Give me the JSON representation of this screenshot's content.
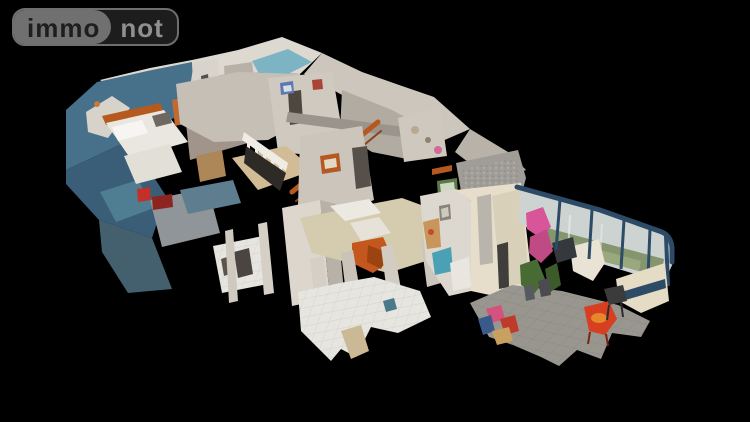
{
  "logo": {
    "brand_left": "immo",
    "brand_right": "not"
  },
  "scene": {
    "label": "3D dollhouse cutaway model of a two-storey house: blue bedroom upper left, staircase and landing in the centre, kitchen and living room on the ground floor, glazed conservatory with garden view on the right"
  },
  "colors": {
    "page_bg": "#000000",
    "logo_left_bg": "#707070",
    "logo_left_text": "#1e1e1e",
    "logo_right_bg": "#1d1d1d",
    "logo_right_text": "#8f8f8f",
    "logo_outline": "#6e6e6e",
    "blue_wall": "#47708b",
    "blue_wall_dark": "#3a5e77",
    "teal_floor": "#4f7d92",
    "roof_white": "#ded9d0",
    "roof_gray": "#ccc6bc",
    "wall_light": "#d9d4cb",
    "wall_taupe": "#a1948a",
    "floor_tan": "#d2bc95",
    "floor_beige": "#d5cbae",
    "tile_white": "#e7e5df",
    "orange_accent": "#b5591f",
    "orange_couch": "#c4571d",
    "bed_white": "#eae7e0",
    "kitchen_gray": "#8f9598",
    "counter_blue": "#5e7e90",
    "teal_wall_dark": "#44606e",
    "sign_red": "#c2302a",
    "veranda_frame": "#2d4a66",
    "veranda_glass": "#cdd3d1",
    "garden_green": "#85966e",
    "veranda_floor": "#98968f",
    "cream_panel": "#e4dcc4",
    "plant_green": "#486a33",
    "pink_clothes": "#d8559a",
    "red_chair": "#d64020",
    "gravel_gray": "#a09d98"
  }
}
